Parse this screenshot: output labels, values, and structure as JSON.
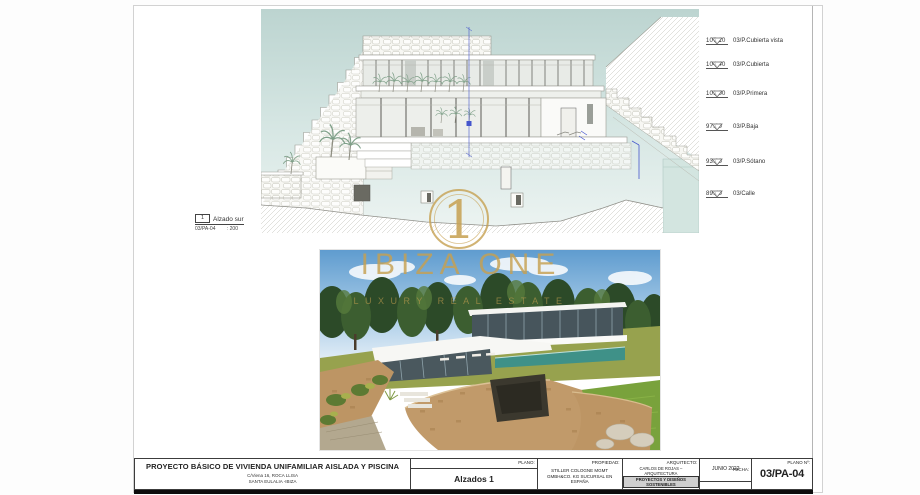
{
  "sheet": {
    "view_label": {
      "number": "1",
      "title": "Alzado sur",
      "code": "03/PA-04",
      "scale": ": 200"
    },
    "level_markers": [
      {
        "value": "107.10",
        "label": "03/P.Cubierta vista"
      },
      {
        "value": "104.40",
        "label": "03/P.Cubierta"
      },
      {
        "value": "101.00",
        "label": "03/P.Primera"
      },
      {
        "value": "97.00",
        "label": "03/P.Baja"
      },
      {
        "value": "93.00",
        "label": "03/P.Sótano"
      },
      {
        "value": "89.40",
        "label": "03/Calle"
      }
    ],
    "watermark": {
      "numeral": "1",
      "brand": "IBIZA ONE",
      "tagline": "LUXURY REAL ESTATE",
      "color": "#c6a050"
    },
    "title_block": {
      "project_title": "PROYECTO BÁSICO DE VIVIENDA UNIFAMILIAR AISLADA Y PISCINA",
      "address_line1": "C/Viena 16, ROCA LLISA",
      "address_line2": "SANTA EULALIA -IBIZA",
      "plano_label": "PLANO:",
      "plano_name": "Alzados 1",
      "propiedad_label": "PROPIEDAD:",
      "propiedad_name": "STILLER COLOGNE MGMT GMBH&CO. KG SUCURSAL EN ESPAÑA",
      "arquitecto_label": "ARQUITECTO:",
      "arquitecto_line1": "CARLOS DE ROJAS – ARQUITECTURA",
      "arquitecto_line2": "PROYECTOS Y DISEÑOS SOSTENIBLES",
      "arquitecto_line3": "Avda. Manoteras nº38. Esc. 4 - 206",
      "arquitecto_line4": "28050 -MADRID- pdsostenibles@gmail.com",
      "fecha_label": "FECHA:",
      "fecha_value": "JUNIO 2022",
      "escala_label": "ESCALA:",
      "escala_value": "1:200",
      "plano_num_label": "PLANO Nº:",
      "plano_num_value": "03/PA-04"
    }
  }
}
